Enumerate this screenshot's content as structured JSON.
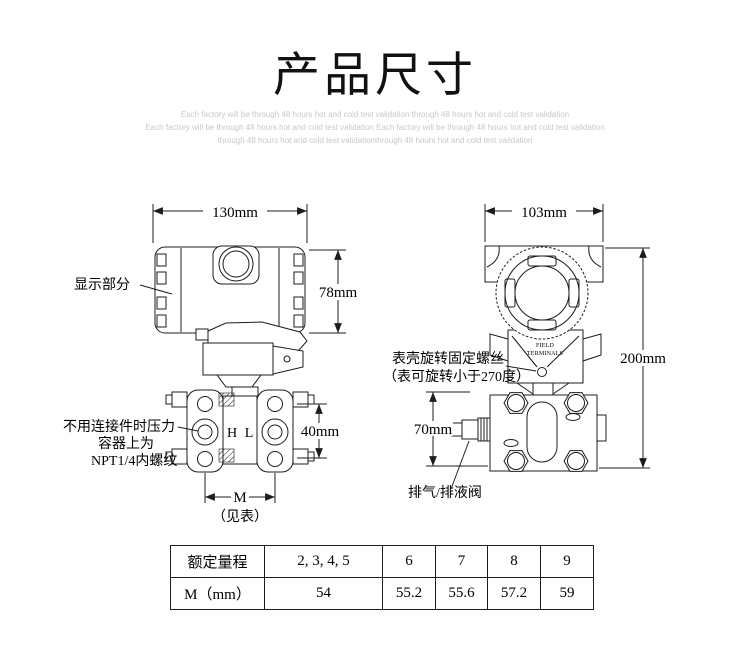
{
  "header": {
    "title": "产品尺寸",
    "subtitle_line1": "Each factory will be through 48 hours hot and cold test validation through 48 hours hot and cold test validation",
    "subtitle_line2": "Each factory will be through 48 hours hot and cold test validation Each factory will be through 48 hours hot and cold test validation",
    "subtitle_line3": "through 48 hours hot and cold test validationthrough 48 hours hot and cold test validation"
  },
  "side_view": {
    "width_dim": "130mm",
    "height_dim": "78mm",
    "flange_dim": "40mm",
    "span_dim": "M",
    "span_note": "（见表）",
    "display_label": "显示部分",
    "npt_label_line1": "不用连接件时压力",
    "npt_label_line2": "容器上为",
    "npt_label_line3": "NPT1/4内螺纹",
    "high_port": "H",
    "low_port": "L"
  },
  "front_view": {
    "width_dim": "103mm",
    "height_dim": "200mm",
    "flange_dim": "70mm",
    "rotation_label_line1": "表壳旋转固定螺丝",
    "rotation_label_line2": "（表可旋转小于270度）",
    "vent_label": "排气/排液阀",
    "terminal_line1": "FIELD",
    "terminal_line2": "TERMINALS"
  },
  "table": {
    "header_row": [
      "额定量程",
      "2, 3, 4, 5",
      "6",
      "7",
      "8",
      "9"
    ],
    "value_row": [
      "M（mm）",
      "54",
      "55.2",
      "55.6",
      "57.2",
      "59"
    ]
  },
  "colors": {
    "line": "#1c1c1c",
    "subtitle": "#c8c8c8"
  }
}
